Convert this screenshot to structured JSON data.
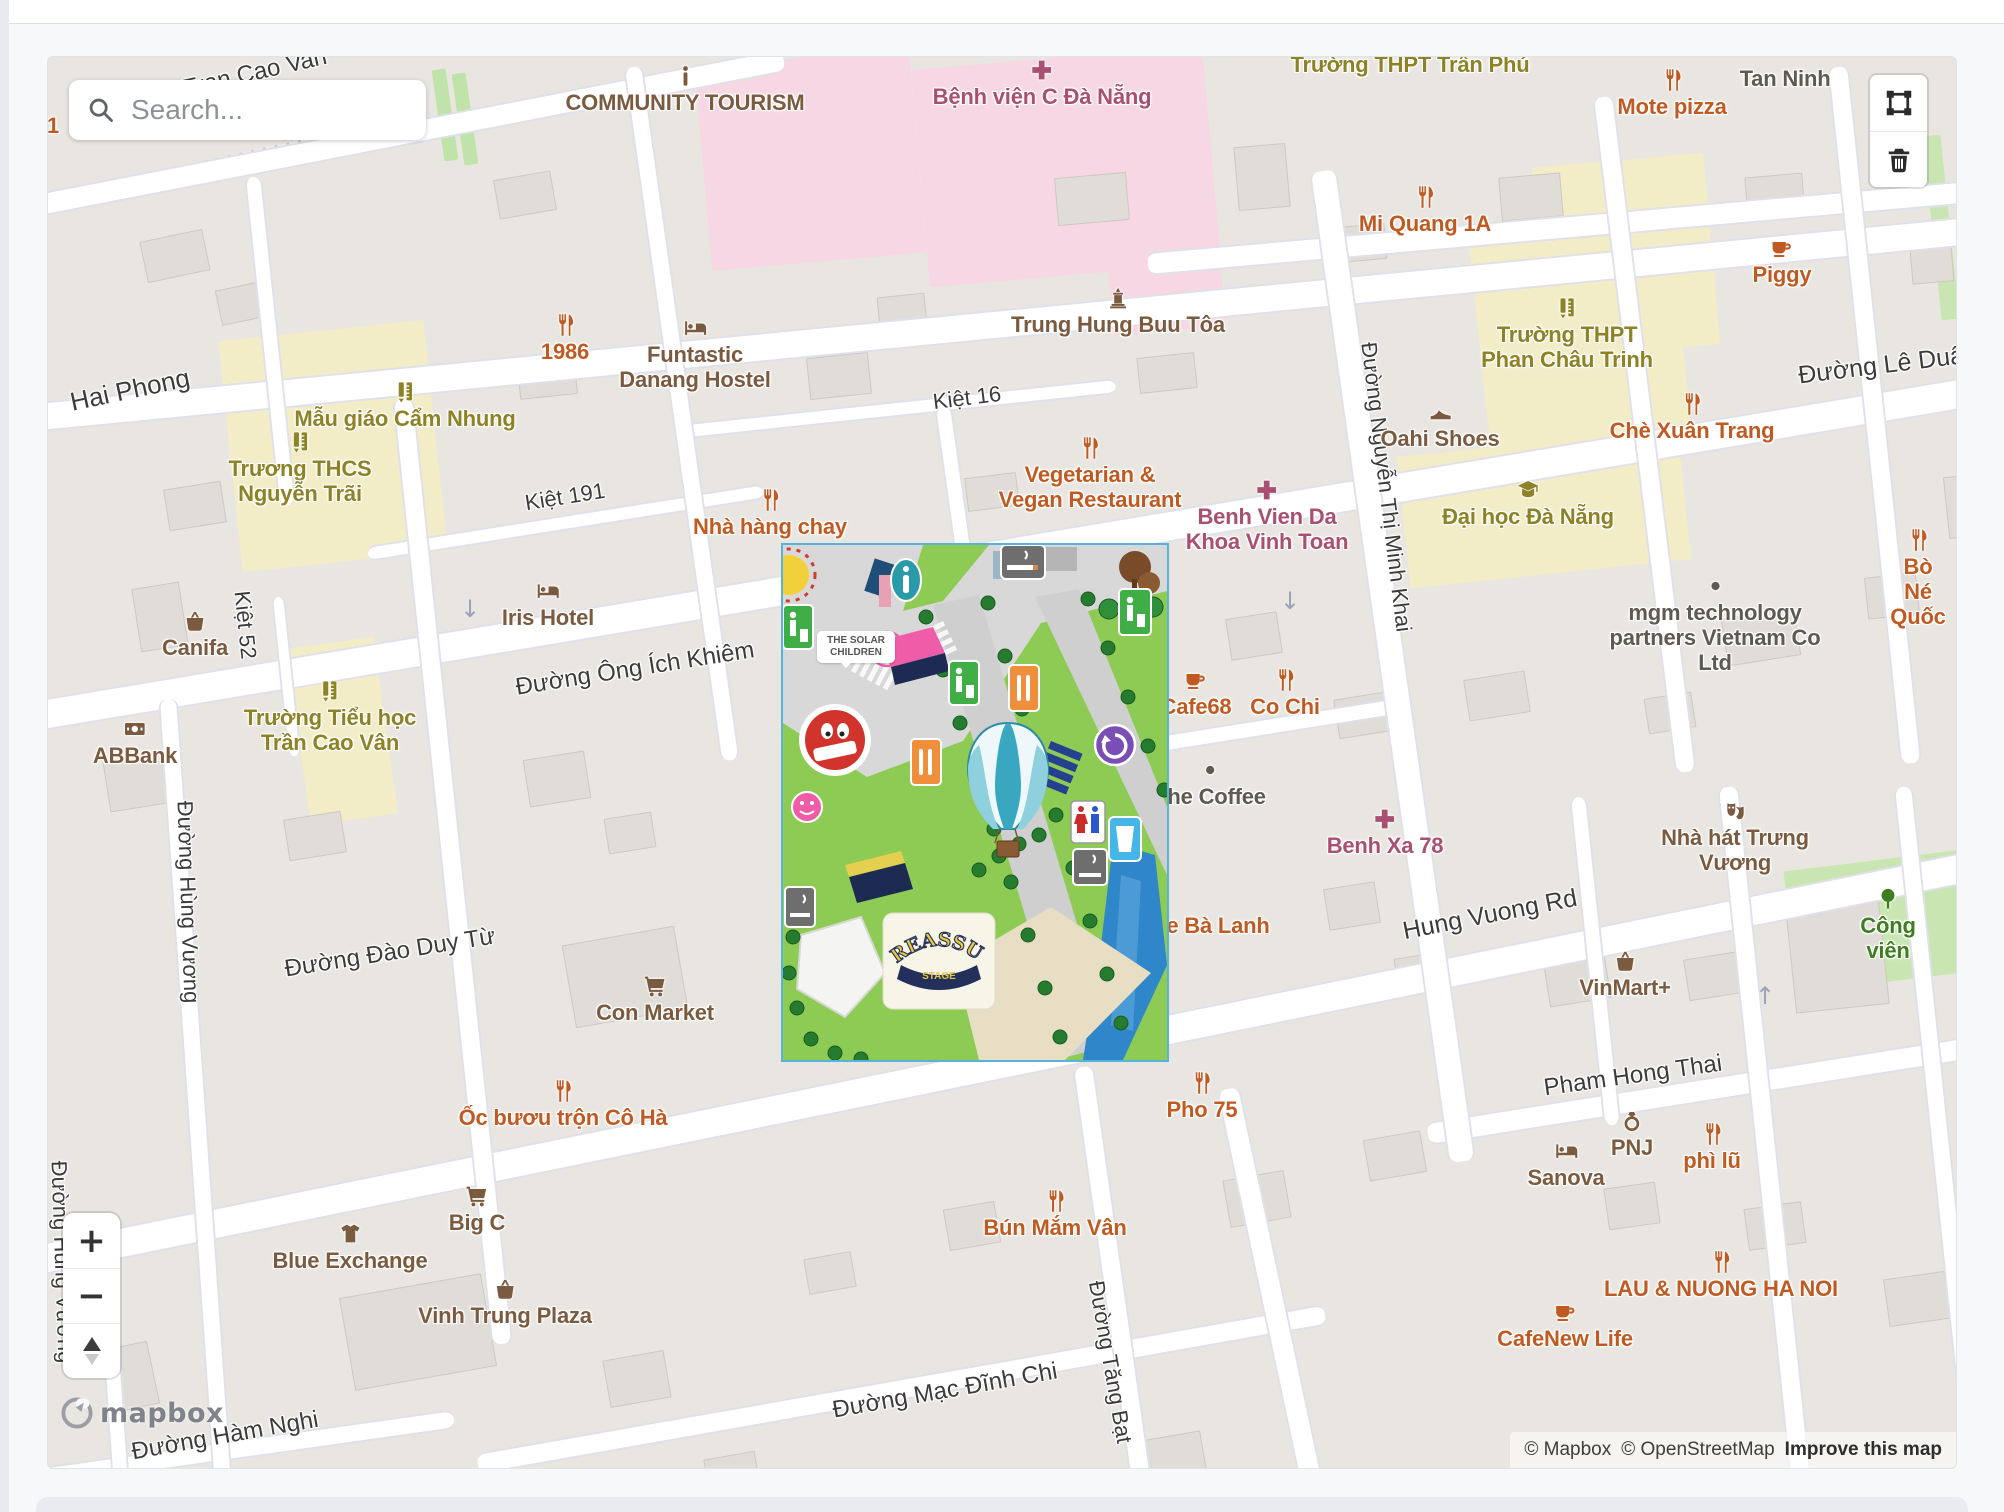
{
  "search": {
    "placeholder": "Search..."
  },
  "branding": {
    "logo": "mapbox"
  },
  "attribution": {
    "mapbox": "© Mapbox",
    "osm": "© OpenStreetMap",
    "improve": "Improve this map"
  },
  "controls": {
    "zoom_in": "+",
    "zoom_out": "−",
    "draw_polygon": "polygon-tool",
    "delete_drawing": "trash-tool",
    "compass": "compass"
  },
  "overlay": {
    "solar_text": "THE SOLAR\nCHILDREN",
    "stage_name": "REASSURE",
    "stage_label": "STAGE"
  },
  "colors": {
    "poi_food": "#bf5b22",
    "poi_shop": "#7a5b40",
    "poi_school": "#8d8226",
    "poi_hospital": "#a84f72",
    "poi_generic": "#5f594f",
    "poi_park": "#3e7d20",
    "land": "#e9e6e1",
    "road": "#ffffff",
    "school_area": "#f2ecc7",
    "hospital_area": "#f6d7e3",
    "park_area": "#c9e6b2",
    "overlay_border": "#56b3d9"
  },
  "map": {
    "pois": [
      {
        "l": "COMMUNITY TOURISM",
        "i": "info",
        "t": "brown",
        "x": 637,
        "y": 6
      },
      {
        "l": "Bệnh viện C Đà Nẵng",
        "i": "cross",
        "t": "hosp",
        "x": 994,
        "y": 0
      },
      {
        "l": "Trường THPT Trần Phú",
        "t": "school",
        "x": 1362,
        "y": -6
      },
      {
        "l": "Tan Ninh",
        "t": "gray",
        "x": 1737,
        "y": 8
      },
      {
        "l": "Mote pizza",
        "i": "rest",
        "t": "food",
        "x": 1624,
        "y": 10
      },
      {
        "l": "Mi Quang 1A",
        "i": "rest",
        "t": "food",
        "x": 1377,
        "y": 127
      },
      {
        "l": "Piggy",
        "i": "cafe",
        "t": "food",
        "x": 1734,
        "y": 178
      },
      {
        "l": "1986",
        "i": "rest",
        "t": "food",
        "x": 517,
        "y": 255
      },
      {
        "l": "Funtastic\nDanang Hostel",
        "i": "bed",
        "t": "brown",
        "x": 647,
        "y": 258
      },
      {
        "l": "Trung Hung Buu Tôa",
        "i": "temple",
        "t": "brown",
        "x": 1070,
        "y": 228
      },
      {
        "l": "Trường THPT\nPhan Châu Trinh",
        "i": "school",
        "t": "school",
        "x": 1519,
        "y": 238
      },
      {
        "l": "Mẫu giáo Cẩm Nhung",
        "i": "school",
        "t": "school",
        "x": 357,
        "y": 322
      },
      {
        "l": "Oahi Shoes",
        "i": "shoe",
        "t": "brown",
        "x": 1392,
        "y": 342
      },
      {
        "l": "Chè Xuân Trang",
        "i": "rest",
        "t": "food",
        "x": 1644,
        "y": 334
      },
      {
        "l": "Trương THCS\nNguyễn Trãi",
        "i": "school",
        "t": "school",
        "x": 252,
        "y": 372
      },
      {
        "l": "Vegetarian &\nVegan Restaurant",
        "i": "rest",
        "t": "food",
        "x": 1042,
        "y": 378
      },
      {
        "l": "Benh Vien Da\nKhoa Vinh Toan",
        "i": "cross",
        "t": "hosp",
        "x": 1219,
        "y": 420
      },
      {
        "l": "Đại học Đà Nẵng",
        "i": "grad",
        "t": "school",
        "x": 1480,
        "y": 420
      },
      {
        "l": "Nhà hàng chay",
        "i": "rest",
        "t": "food",
        "x": 722,
        "y": 430
      },
      {
        "l": "Bò Né Quốc",
        "i": "rest",
        "t": "food",
        "x": 1870,
        "y": 470
      },
      {
        "l": "Canifa",
        "i": "basket",
        "t": "brown",
        "x": 147,
        "y": 551
      },
      {
        "l": "Iris Hotel",
        "i": "bed",
        "t": "brown",
        "x": 500,
        "y": 521
      },
      {
        "l": "mgm technology\npartners Vietnam Co Ltd",
        "i": "dot",
        "t": "gray",
        "x": 1667,
        "y": 516
      },
      {
        "l": "Cafe68",
        "i": "cafe",
        "t": "food",
        "x": 1148,
        "y": 610
      },
      {
        "l": "Co Chi",
        "i": "rest",
        "t": "food",
        "x": 1237,
        "y": 610
      },
      {
        "l": "Trường Tiểu học\nTrần Cao Vân",
        "i": "school",
        "t": "school",
        "x": 282,
        "y": 621
      },
      {
        "l": "ABBank",
        "i": "money",
        "t": "brown",
        "x": 87,
        "y": 659
      },
      {
        "l": "The Coffee",
        "i": "dot",
        "t": "gray",
        "x": 1162,
        "y": 700
      },
      {
        "l": "Benh Xa 78",
        "i": "cross",
        "t": "hosp",
        "x": 1337,
        "y": 749
      },
      {
        "l": "Nhà hát Trưng Vương",
        "i": "theater",
        "t": "brown",
        "x": 1687,
        "y": 741
      },
      {
        "l": "e Bà Lanh",
        "t": "food",
        "x": 1170,
        "y": 855
      },
      {
        "l": "Công viên",
        "i": "tree",
        "t": "park",
        "x": 1840,
        "y": 829
      },
      {
        "l": "Con Market",
        "i": "cart",
        "t": "brown",
        "x": 607,
        "y": 916
      },
      {
        "l": "VinMart+",
        "i": "basket",
        "t": "brown",
        "x": 1577,
        "y": 891
      },
      {
        "l": "Ốc bươu trộn Cô Hà",
        "i": "rest",
        "t": "food",
        "x": 515,
        "y": 1021
      },
      {
        "l": "Pho 75",
        "i": "rest",
        "t": "food",
        "x": 1154,
        "y": 1013
      },
      {
        "l": "PNJ",
        "i": "ring",
        "t": "brown",
        "x": 1584,
        "y": 1051
      },
      {
        "l": "phì lũ",
        "i": "rest",
        "t": "food",
        "x": 1664,
        "y": 1064
      },
      {
        "l": "Sanova",
        "i": "bed",
        "t": "brown",
        "x": 1518,
        "y": 1081
      },
      {
        "l": "Big C",
        "i": "cart",
        "t": "brown",
        "x": 429,
        "y": 1126
      },
      {
        "l": "Bún Mắm Vân",
        "i": "rest",
        "t": "food",
        "x": 1007,
        "y": 1131
      },
      {
        "l": "Blue Exchange",
        "i": "shirt",
        "t": "brown",
        "x": 302,
        "y": 1164
      },
      {
        "l": "LAU & NUONG HA NOI",
        "i": "rest",
        "t": "food",
        "x": 1673,
        "y": 1192
      },
      {
        "l": "Vinh Trung Plaza",
        "i": "basket",
        "t": "brown",
        "x": 457,
        "y": 1219
      },
      {
        "l": "CafeNew Life",
        "i": "cafe",
        "t": "food",
        "x": 1517,
        "y": 1242
      },
      {
        "l": "1",
        "t": "food",
        "x": 5,
        "y": 55
      }
    ],
    "streets": [
      {
        "l": "Tran Cao Van",
        "x": 207,
        "y": 16,
        "r": -13,
        "s": 24
      },
      {
        "l": "Hai Phong",
        "x": 82,
        "y": 333,
        "r": -12,
        "s": 26
      },
      {
        "l": "Kiệt 16",
        "x": 919,
        "y": 341,
        "r": -7,
        "s": 22
      },
      {
        "l": "Kiệt 191",
        "x": 517,
        "y": 440,
        "r": -9,
        "s": 22
      },
      {
        "l": "Đường Lê Duẩn",
        "x": 1840,
        "y": 308,
        "r": -7,
        "s": 25
      },
      {
        "l": "Kiệt 52",
        "x": 197,
        "y": 568,
        "r": 84,
        "s": 22
      },
      {
        "l": "Đường Ông Ích Khiêm",
        "x": 587,
        "y": 612,
        "r": -9,
        "s": 24
      },
      {
        "l": "Đường Nguyễn Thị Minh Khai",
        "x": 1338,
        "y": 430,
        "r": 83,
        "s": 22
      },
      {
        "l": "Đường Hùng Vương",
        "x": 140,
        "y": 845,
        "r": 88,
        "s": 22
      },
      {
        "l": "Đường Đào Duy Từ",
        "x": 342,
        "y": 896,
        "r": -9,
        "s": 24
      },
      {
        "l": "Hung Vuong Rd",
        "x": 1442,
        "y": 858,
        "r": -11,
        "s": 25
      },
      {
        "l": "Pham Hong Thai",
        "x": 1585,
        "y": 1019,
        "r": -8,
        "s": 24
      },
      {
        "l": "Đường Mạc Đĩnh Chi",
        "x": 897,
        "y": 1334,
        "r": -10,
        "s": 24
      },
      {
        "l": "Đường Tăng Bạt",
        "x": 1062,
        "y": 1305,
        "r": 80,
        "s": 22
      },
      {
        "l": "Đường Hàm Nghi",
        "x": 177,
        "y": 1379,
        "r": -10,
        "s": 24
      },
      {
        "l": "Đường Hùng Vương",
        "x": 14,
        "y": 1205,
        "r": 88,
        "s": 22
      }
    ]
  }
}
